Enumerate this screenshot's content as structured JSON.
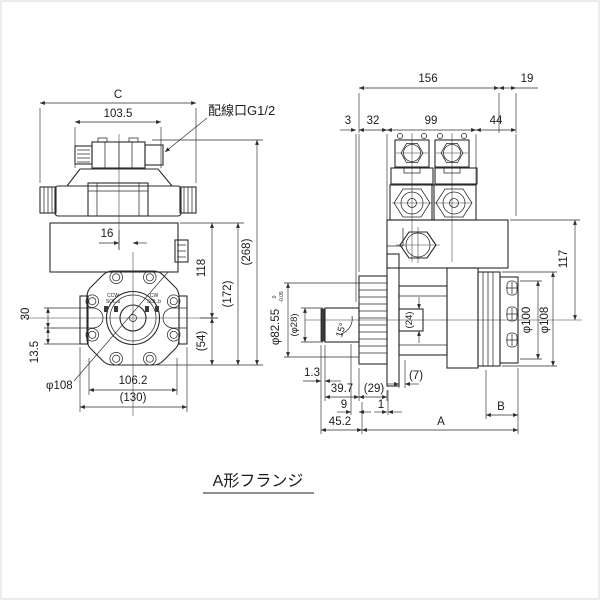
{
  "caption": "A形フランジ",
  "front_view": {
    "dim_c": "C",
    "dim_1035": "103.5",
    "wiring_port": "配線口G1/2",
    "dim_16": "16",
    "dim_118": "118",
    "dim_172": "(172)",
    "dim_268": "(268)",
    "dim_54": "(54)",
    "dim_30": "30",
    "dim_135": "13.5",
    "dim_phi108": "φ108",
    "dim_1062": "106.2",
    "dim_130": "(130)",
    "sol_left_line1": "CCW",
    "sol_left_line2": "SOL.a",
    "sol_right_line1": "CW",
    "sol_right_line2": "SOL.b"
  },
  "side_view": {
    "dim_156": "156",
    "dim_19": "19",
    "dim_3": "3",
    "dim_32": "32",
    "dim_99": "99",
    "dim_44": "44",
    "dim_117": "117",
    "dim_phi100": "φ100",
    "dim_phi108": "φ108",
    "dim_phi8255": "φ82.55",
    "tol_upper": "0",
    "tol_lower": "-0.05",
    "dim_phi28": "(φ28)",
    "dim_15deg": "15°",
    "dim_13": "1.3",
    "dim_397": "39.7",
    "dim_29": "(29)",
    "dim_9": "9",
    "dim_1": "1",
    "dim_452": "45.2",
    "dim_7": "(7)",
    "dim_24": "(24)",
    "dim_a": "A",
    "dim_b": "B"
  }
}
